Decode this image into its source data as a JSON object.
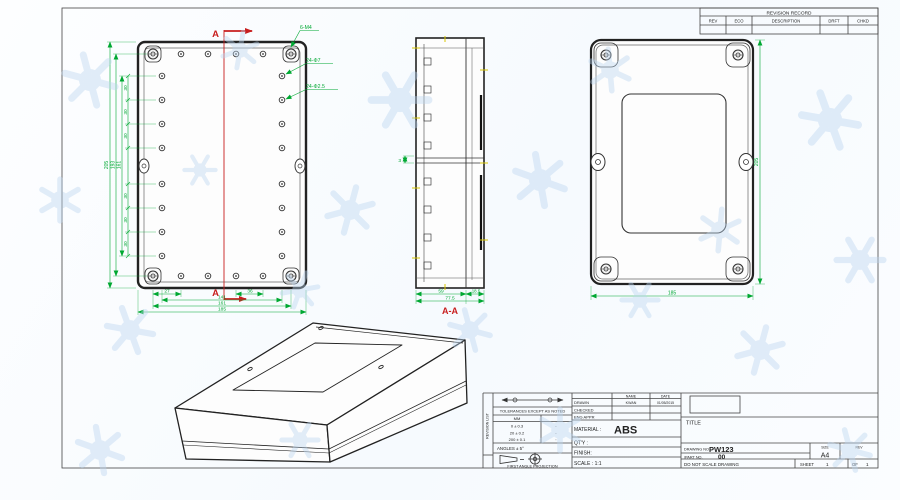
{
  "sheet": {
    "revision_table": {
      "title": "REVISION RECORD",
      "col_rev": "REV",
      "col_eco": "ECO",
      "col_description": "DESCRIPTION",
      "col_drft": "DRFT",
      "col_chkd": "CHKD"
    },
    "views": {
      "top": {
        "section_letter": "A",
        "callout_corner": "6-M4",
        "callout_holes": "24-Φ7",
        "callout_small_holes": "24-Φ2.5",
        "seg": "30",
        "h_total": "205",
        "h_screws": "193",
        "h_holes": "161",
        "w_edge": "27",
        "w_step": "36",
        "w_inner": "141",
        "w_screws": "161",
        "w_total": "185"
      },
      "section": {
        "label": "A-A",
        "depth_main": "59",
        "depth_lid": "18.5",
        "depth_total": "77.5",
        "wall": "3"
      },
      "back": {
        "height": "205",
        "width": "185"
      }
    },
    "title_block": {
      "strip": "REVISION LIST",
      "tol_heading": "TOLERANCES EXCEPT AS NOTED",
      "tol_unit": "MM",
      "tol_r1": "0 ± 0.3",
      "tol_r2": "20 ± 0.2",
      "tol_r3": "200 ± 0.1",
      "dot": "·",
      "angles": "ANGLES ± 5°",
      "projection": "FIRST ANGLE PROJECTION",
      "name_h": "NAME",
      "date_h": "DATE",
      "drawn": "DRAWN",
      "drawn_name": "KWAN",
      "drawn_date": "01/05/2015",
      "checked": "CHECKED",
      "eng_appr": "ENG APPR",
      "material_label": "MATERIAL :",
      "material": "ABS",
      "qty": "QT'Y :",
      "finish": "FINISH:",
      "scale": "SCALE : 1:1",
      "title": "TITLE",
      "drawing_no_label": "DRAWING NO.",
      "drawing_no": "PW123",
      "part_no_label": "/PART NO.",
      "part_no": "00",
      "size_label": "SIZE",
      "size": "A4",
      "rev_label": "REV",
      "do_not_scale": "DO NOT SCALE DRAWING",
      "sheet_label": "SHEET",
      "sheet_no": "1",
      "of_label": "OF",
      "of_no": "1"
    }
  }
}
